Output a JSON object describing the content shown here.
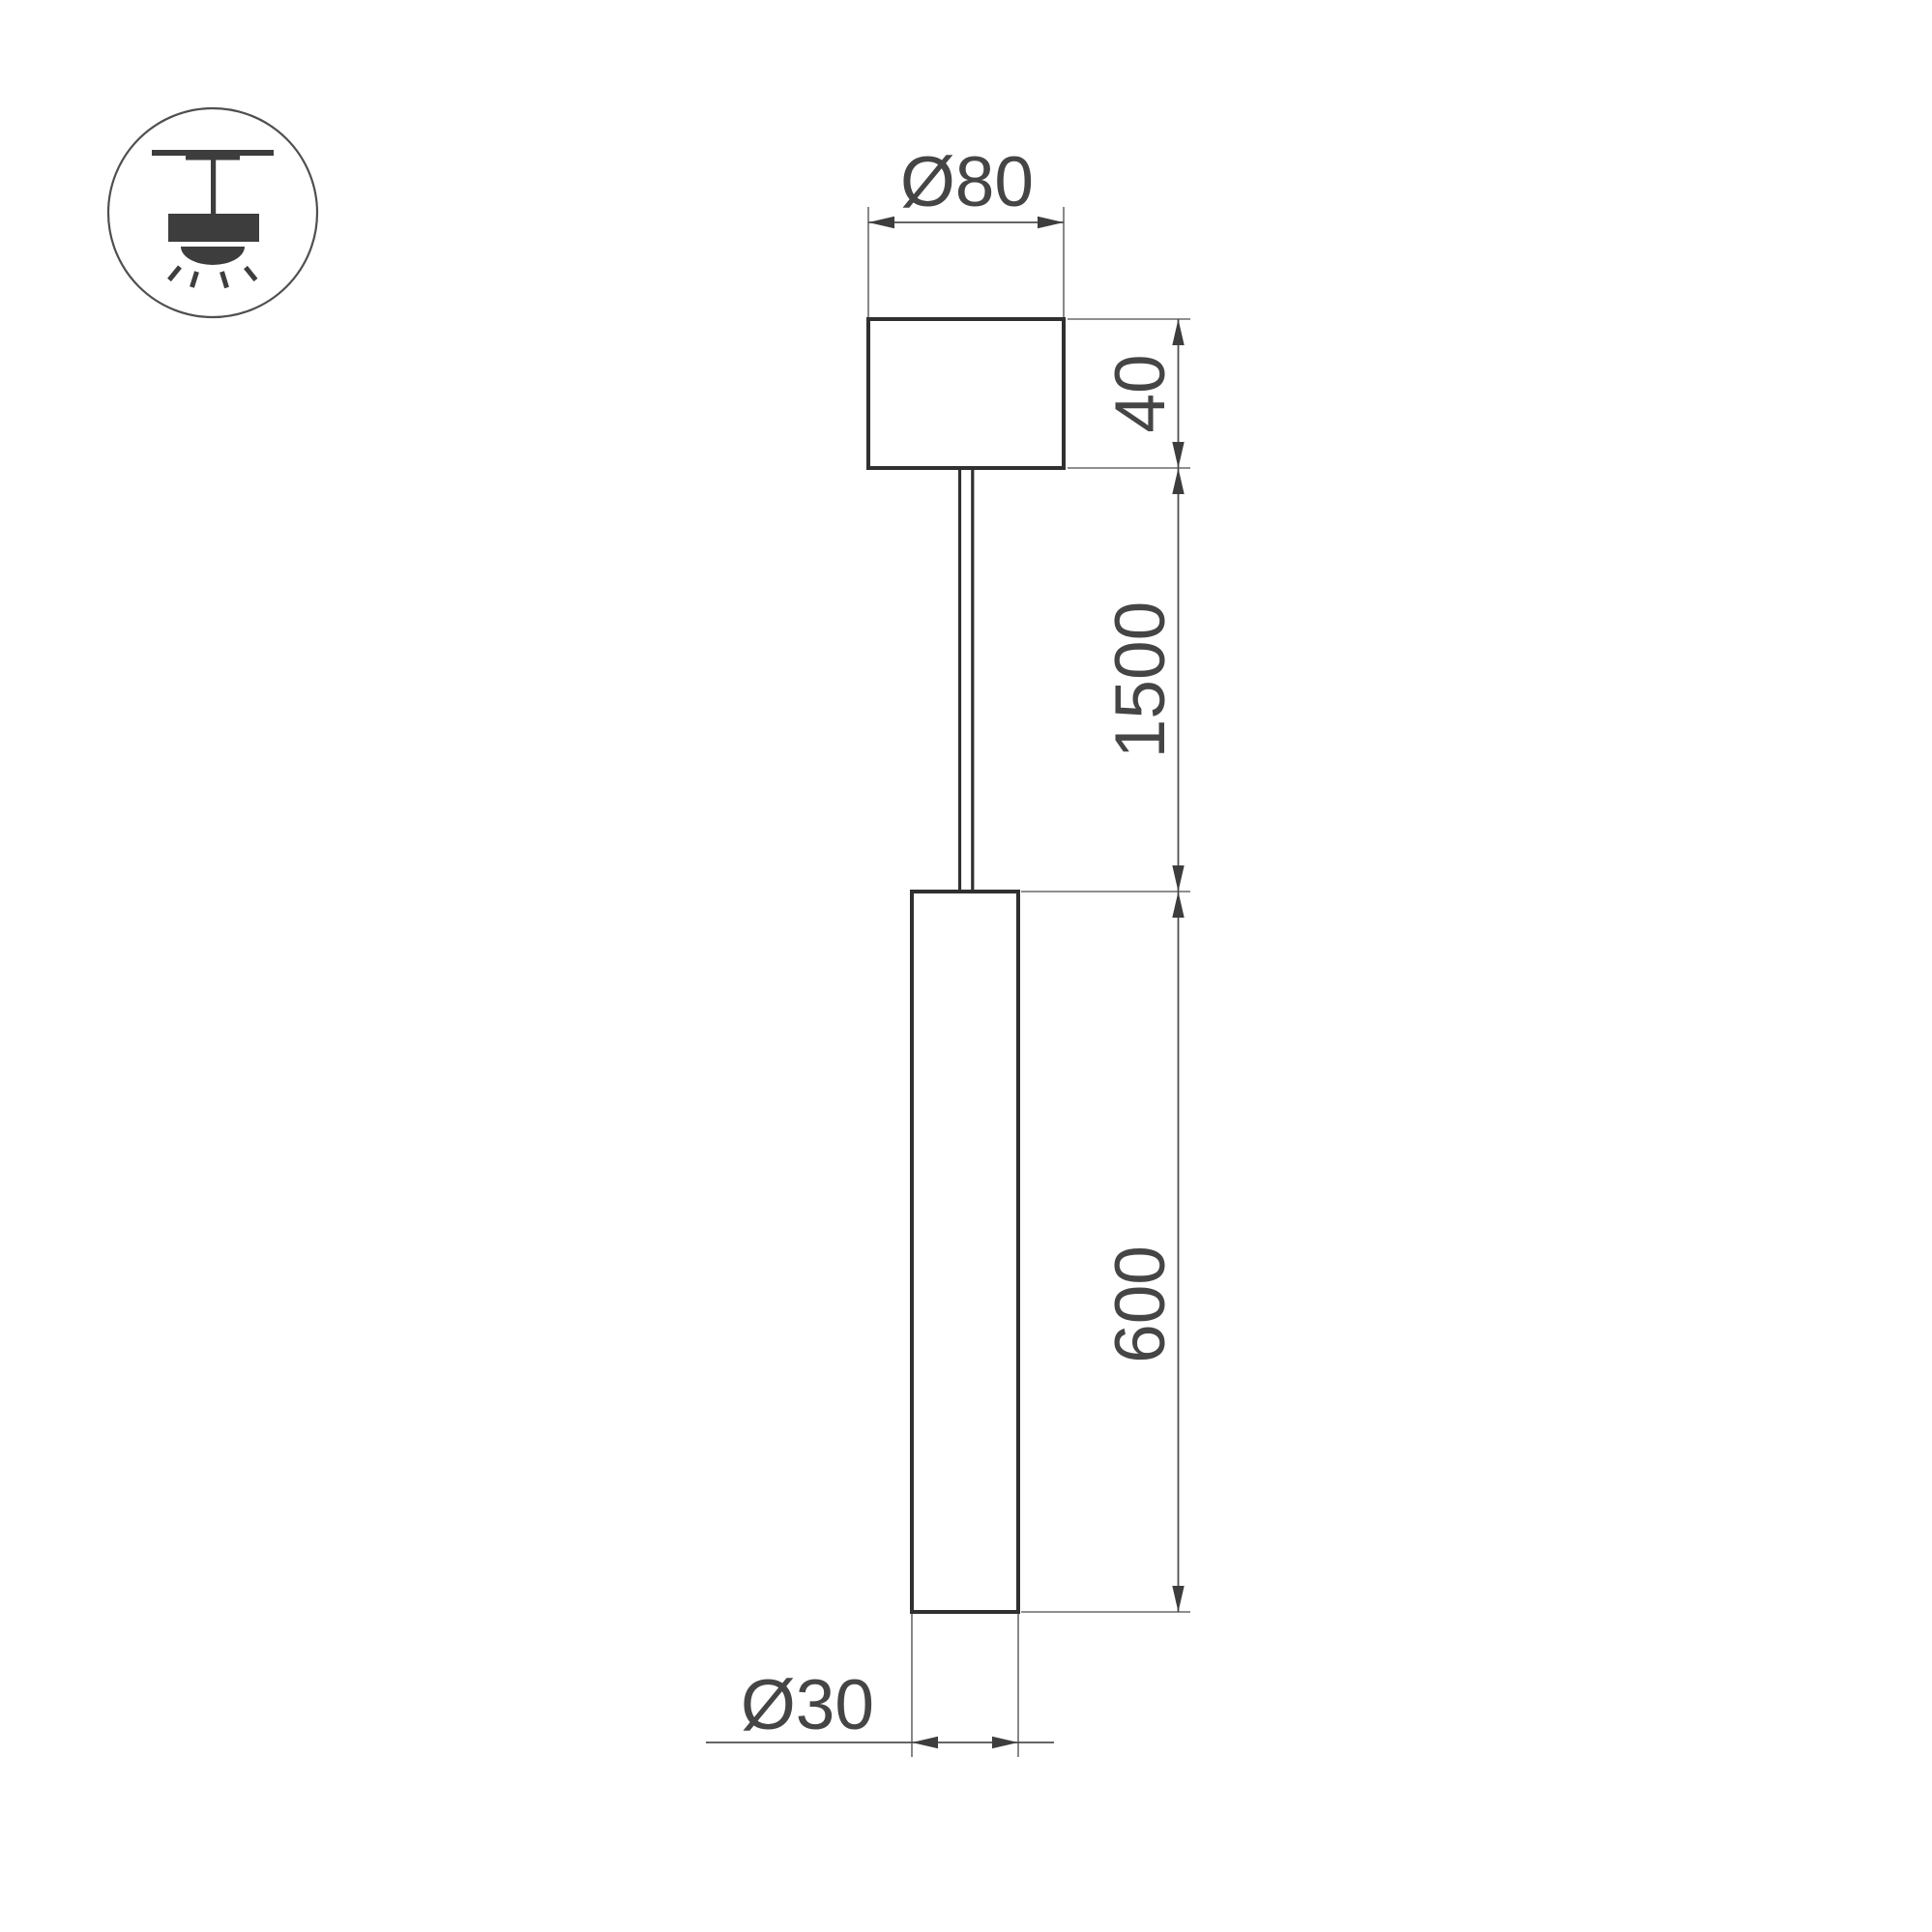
{
  "drawing": {
    "type": "technical-dimension-drawing",
    "subject": "pendant-tube-luminaire",
    "icon": {
      "label": "pendant-ceiling-light-icon"
    },
    "dimensions": {
      "canopy_diameter": "Ø80",
      "canopy_height": "40",
      "suspension_length": "1500",
      "tube_length": "600",
      "tube_diameter": "Ø30"
    },
    "colors": {
      "outline": "#303030",
      "dimension_line": "#4f4f4f",
      "arrow": "#3d3d3d",
      "text": "#454545",
      "icon": "#3d3d3d",
      "background": "#ffffff"
    }
  }
}
